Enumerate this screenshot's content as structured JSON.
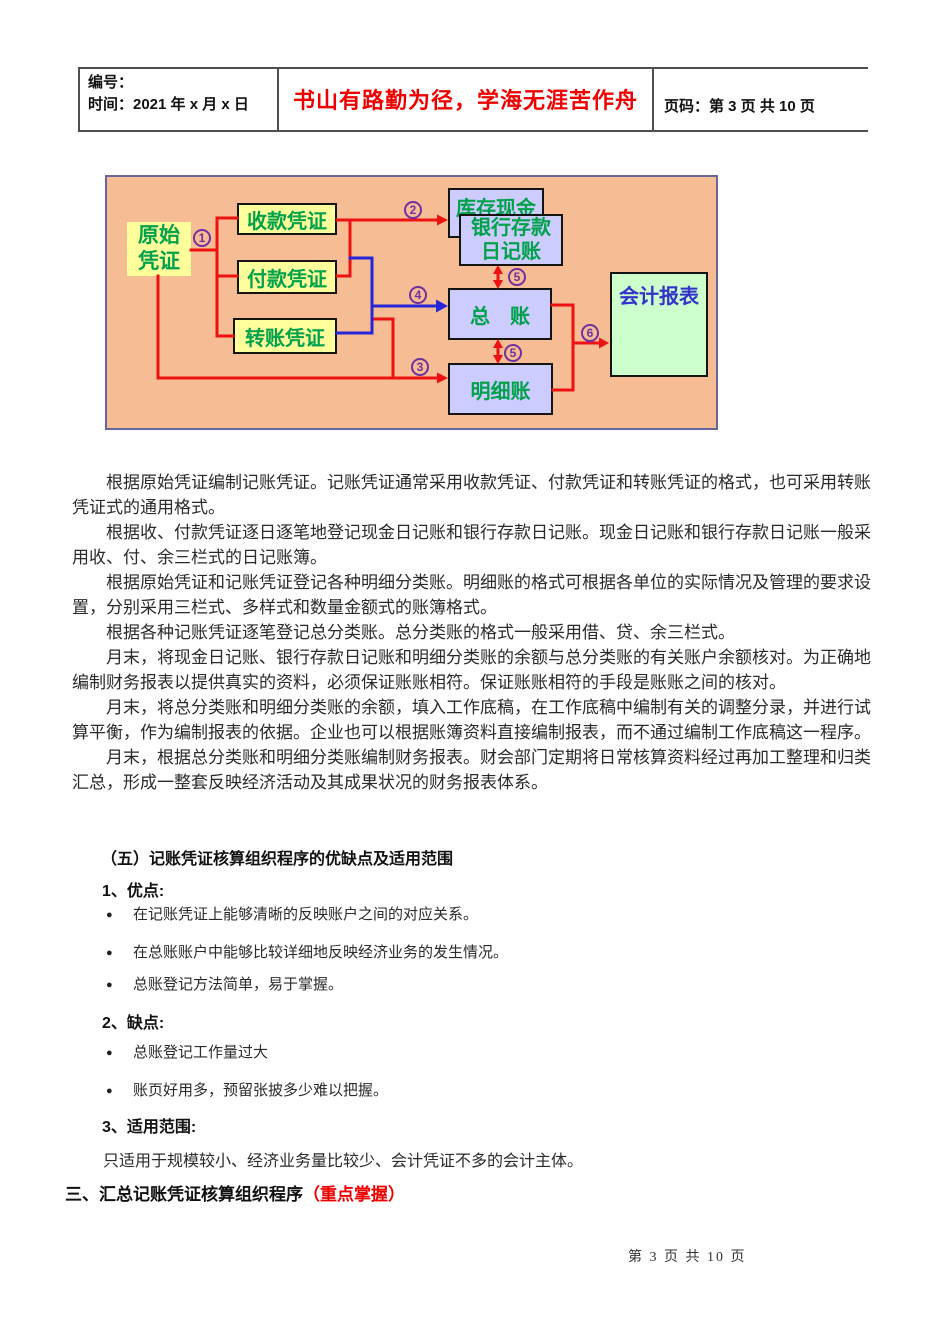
{
  "header": {
    "number_label": "编号：",
    "time_label": "时间：2021 年 x 月 x 日",
    "motto": "书山有路勤为径，学海无涯苦作舟",
    "page_label": "页码：第 3 页 共 10 页"
  },
  "diagram": {
    "nodes": {
      "original_voucher": "原始\n凭证",
      "receipt_voucher": "收款凭证",
      "payment_voucher": "付款凭证",
      "transfer_voucher": "转账凭证",
      "cash_on_hand": "库存现金",
      "bank_deposit_journal": "银行存款\n日记账",
      "general_ledger": "总　账",
      "subsidiary_ledger": "明细账",
      "accounting_report": "会计报表"
    },
    "steps": {
      "step1": "1",
      "step2": "2",
      "step3": "3",
      "step4": "4",
      "step5": "5",
      "step6": "6"
    },
    "colors": {
      "background": "#F6BD94",
      "box_yellow": "#FFFF9C",
      "box_purple": "#CCCCFF",
      "box_green": "#CCFFCC",
      "text_green": "#00A14B",
      "text_blue": "#3333CC",
      "line_red": "#EE1111",
      "line_blue": "#2626D8",
      "circle_purple": "#7030A0"
    }
  },
  "body": {
    "paragraphs": [
      "根据原始凭证编制记账凭证。记账凭证通常采用收款凭证、付款凭证和转账凭证的格式，也可采用转账\n凭证式的通用格式。",
      "根据收、付款凭证逐日逐笔地登记现金日记账和银行存款日记账。现金日记账和银行存款日记账一般采\n用收、付、余三栏式的日记账簿。",
      "根据原始凭证和记账凭证登记各种明细分类账。明细账的格式可根据各单位的实际情况及管理的要求设\n置，分别采用三栏式、多样式和数量金额式的账簿格式。",
      "根据各种记账凭证逐笔登记总分类账。总分类账的格式一般采用借、贷、余三栏式。",
      "月末，将现金日记账、银行存款日记账和明细分类账的余额与总分类账的有关账户余额核对。为正确地\n编制财务报表以提供真实的资料，必须保证账账相符。保证账账相符的手段是账账之间的核对。",
      "月末，将总分类账和明细分类账的余额，填入工作底稿，在工作底稿中编制有关的调整分录，并进行试\n算平衡，作为编制报表的依据。企业也可以根据账簿资料直接编制报表，而不通过编制工作底稿这一程序。",
      "月末，根据总分类账和明细分类账编制财务报表。财会部门定期将日常核算资料经过再加工整理和归类\n汇总，形成一整套反映经济活动及其成果状况的财务报表体系。"
    ]
  },
  "section_five": {
    "title": "（五）记账凭证核算组织程序的优缺点及适用范围",
    "advantages_label": "1、优点:",
    "advantages": [
      "在记账凭证上能够清晰的反映账户之间的对应关系。",
      "在总账账户中能够比较详细地反映经济业务的发生情况。",
      "总账登记方法简单，易于掌握。"
    ],
    "disadvantages_label": "2、缺点:",
    "disadvantages": [
      "总账登记工作量过大",
      "账页好用多，预留张披多少难以把握。"
    ],
    "scope_label": "3、适用范围:",
    "scope_text": "只适用于规模较小、经济业务量比较少、会计凭证不多的会计主体。"
  },
  "section_three": {
    "title": "三、汇总记账凭证核算组织程序",
    "emphasis": "（重点掌握）"
  },
  "footer": {
    "page_info": "第 3 页 共 10 页"
  },
  "glyphs": {
    "bullet": "●"
  }
}
